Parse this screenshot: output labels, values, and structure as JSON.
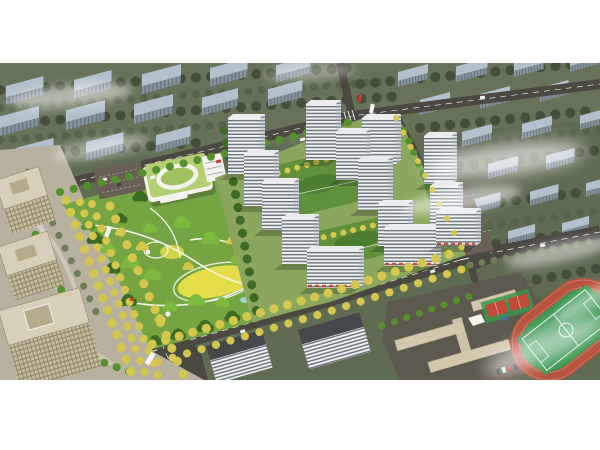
{
  "meta": {
    "type": "aerial-architectural-rendering",
    "alt": "Aerial rendering of a residential masterplan: a cluster of white high-rise apartment towers with green courtyards, a large landscaped central park with winding white paths and a yellow lawn, a kindergarten with a light-green roof and oval courtyard, beige office towers and plaza on the left, tree-lined boulevards with yellow autumn trees, a school campus with red sports courts and a green running-track field at lower right, all surrounded by muted olive-gray context buildings with drifting white mist, letterboxed on a white page."
  },
  "scene": {
    "regions": [
      "context-cityscape",
      "context-buildings",
      "road-network",
      "west-boulevard",
      "office-plaza",
      "office-buildings",
      "central-park",
      "kindergarten",
      "residential-compound",
      "retail-street",
      "school-campus",
      "basketball-courts",
      "running-track-field",
      "street-trees",
      "vehicles",
      "mist-clouds"
    ]
  },
  "colors": {
    "page_bg": "#ffffff",
    "ctx_ground": "#5f6c53",
    "ctx_ground2": "#6d7a5f",
    "ctx_tree_dark": "#434f38",
    "ctx_tree_mid": "#556349",
    "ctx_tree_olive": "#6e7d57",
    "ctx_roof": "#b2c1cd",
    "ctx_wall": "#86949e",
    "ctx_wall_shade": "#69767f",
    "road": "#4b4741",
    "road_brown": "#6a5f55",
    "road_line": "#e9e7df",
    "plaza": "#b8b1a0",
    "plaza_light": "#d7d1c3",
    "park_base": "#75a443",
    "res_ground": "#8ba75d",
    "tree_dark": "#3c6b26",
    "tree_mid": "#55902e",
    "tree_bright": "#7cb93e",
    "tree_yellow": "#d5c74d",
    "lawn_yellow": "#e4dc49",
    "path_white": "#f4f3ed",
    "courtyard": "#5e9139",
    "podium_dark": "#4d7d31",
    "tower_white": "#f1f3f3",
    "tower_stripe": "#6d7882",
    "tower_side": "#d9dde0",
    "tower_side_stripe": "#7f8a93",
    "tower_roof": "#e9ebec",
    "roof_detail": "#d5dadd",
    "slab_dark_roof": "#44484b",
    "awning_red": "#c0503a",
    "beige": "#c8bca0",
    "beige_line": "#93876a",
    "beige_roof": "#d8cfb8",
    "beige_inner": "#b7ab8e",
    "school_roof": "#d3c8ab",
    "school_ground": "#5d594f",
    "court_red": "#bf4a35",
    "court_blue": "#4a6fa5",
    "track_red": "#b6523d",
    "pitch_green": "#2f9049",
    "pitch_green2": "#37984e",
    "kg_roof": "#b3cf72",
    "kg_lawn": "#9fc25e",
    "water": "#a9d3da",
    "shadow": "rgba(25,35,25,0.28)",
    "car_white": "#f4f4f2",
    "car_red": "#c23b2e",
    "car_dark": "#3c4247",
    "mist": "#ffffff"
  }
}
